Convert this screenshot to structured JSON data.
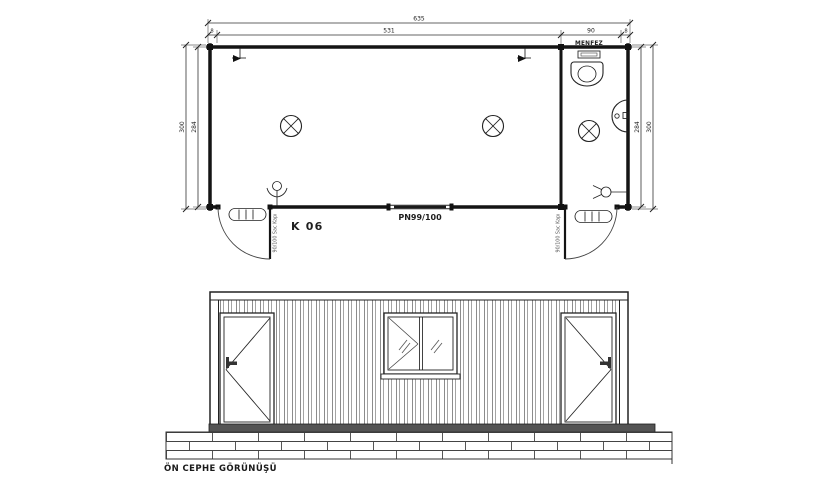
{
  "plan": {
    "dimensions": {
      "total_width": "635",
      "wall_left": "8",
      "main_room": "531",
      "bathroom": "90",
      "wall_right": "8",
      "depth_outer_left": "300",
      "depth_inner_left": "284",
      "depth_inner_right": "284",
      "depth_outer_right": "300"
    },
    "labels": {
      "vent": "MENFEZ",
      "room_code": "K 06",
      "window_code": "PN99/100",
      "left_door": "90/100 Sac Kapı",
      "right_door": "90/100 Sac Kapı"
    }
  },
  "elevation": {
    "title": "ÖN CEPHE GÖRÜNÜŞÜ"
  },
  "colors": {
    "line": "#1f1f1f",
    "corrugation": "#8c8c8c",
    "beam": "#545454"
  }
}
